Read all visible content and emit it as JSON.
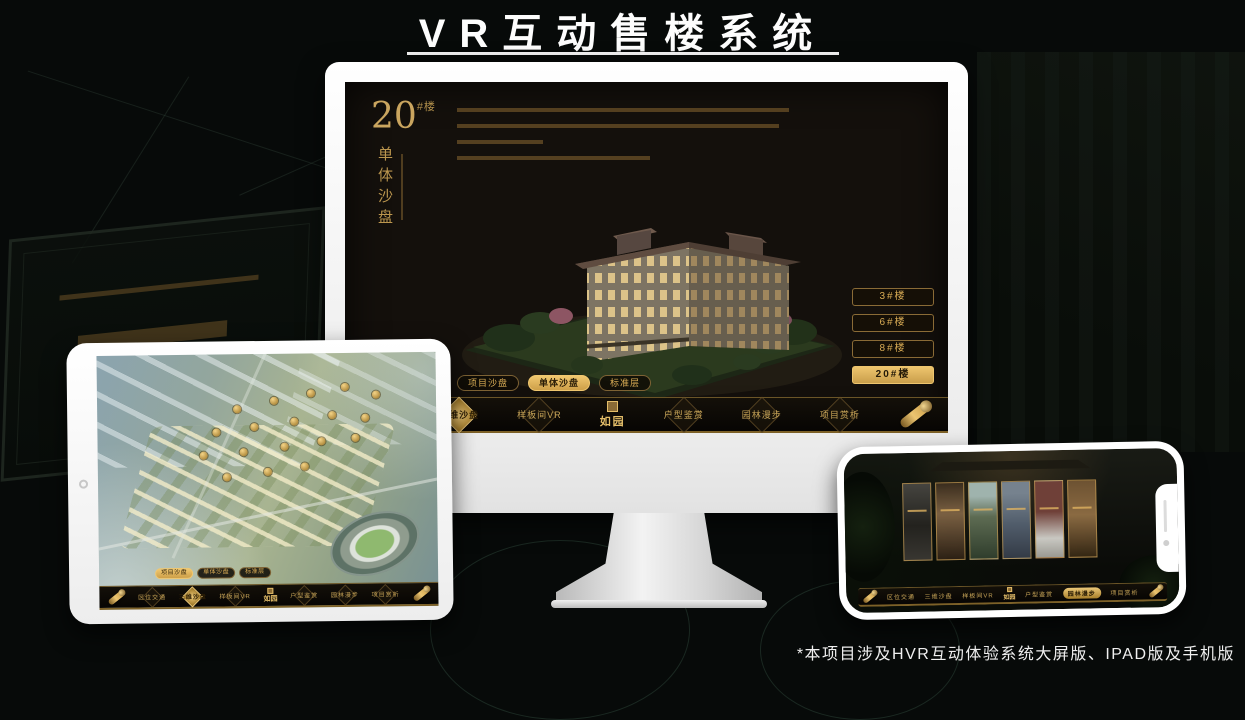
{
  "page": {
    "title": "VR互动售楼系统",
    "footnote": "*本项目涉及HVR互动体验系统大屏版、IPAD版及手机版"
  },
  "brand": {
    "logo": "如园"
  },
  "colors": {
    "gold": "#C9A15C",
    "gold_bright": "#EDC26C",
    "screen_bg": "#14100C",
    "page_bg": "#070A09"
  },
  "nav_items": [
    {
      "label": "区位交通"
    },
    {
      "label": "三维沙盘"
    },
    {
      "label": "样板间VR"
    },
    {
      "label": "户型鉴赏"
    },
    {
      "label": "园林漫步"
    },
    {
      "label": "项目赏析"
    }
  ],
  "tabs": [
    {
      "label": "项目沙盘"
    },
    {
      "label": "单体沙盘"
    },
    {
      "label": "标准层"
    }
  ],
  "desktop": {
    "heading": {
      "number": "20",
      "suffix": "#楼",
      "subtitle": "单体沙盘"
    },
    "floor_buttons": [
      {
        "label": "3#楼"
      },
      {
        "label": "6#楼"
      },
      {
        "label": "8#楼"
      },
      {
        "label": "20#楼"
      }
    ],
    "selected_floor": "20#楼",
    "selected_tab": "单体沙盘",
    "selected_nav": "三维沙盘"
  },
  "tablet": {
    "selected_tab": "项目沙盘",
    "selected_nav": "三维沙盘"
  },
  "phone": {
    "selected_nav": "园林漫步"
  }
}
